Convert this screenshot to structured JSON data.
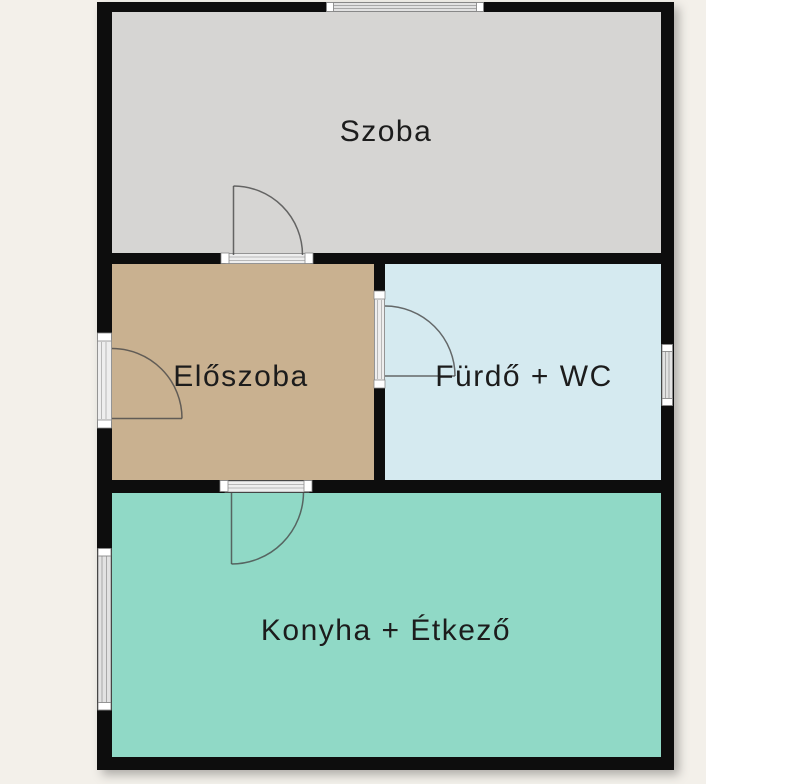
{
  "plan": {
    "type": "apartment floor plan",
    "background_color": "#f3f0ea",
    "margin_color": "#ffffff",
    "wall_color": "#0d0d0d",
    "door_swing_color": "#474747",
    "window_fill_color": "#e2e2e2",
    "rooms": [
      {
        "name": "szoba",
        "label": "Szoba",
        "color": "#d6d5d3"
      },
      {
        "name": "eloszoba",
        "label": "Előszoba",
        "color": "#c9b190"
      },
      {
        "name": "furdo-wc",
        "label": "Fürdő + WC",
        "color": "#d5eaf0"
      },
      {
        "name": "konyha-etkezo",
        "label": "Konyha + Étkező",
        "color": "#90d9c6"
      }
    ],
    "doors": [
      {
        "between": "Szoba – Előszoba",
        "swing": "into Szoba"
      },
      {
        "between": "entry – Előszoba",
        "swing": "into Előszoba"
      },
      {
        "between": "Előszoba – Fürdő + WC",
        "swing": "into Fürdő + WC"
      },
      {
        "between": "Előszoba – Konyha + Étkező",
        "swing": "into Konyha + Étkező"
      }
    ],
    "windows": [
      {
        "wall": "top",
        "room": "Szoba"
      },
      {
        "wall": "right",
        "room": "Fürdő + WC"
      },
      {
        "wall": "left",
        "room": "Konyha + Étkező"
      }
    ]
  }
}
